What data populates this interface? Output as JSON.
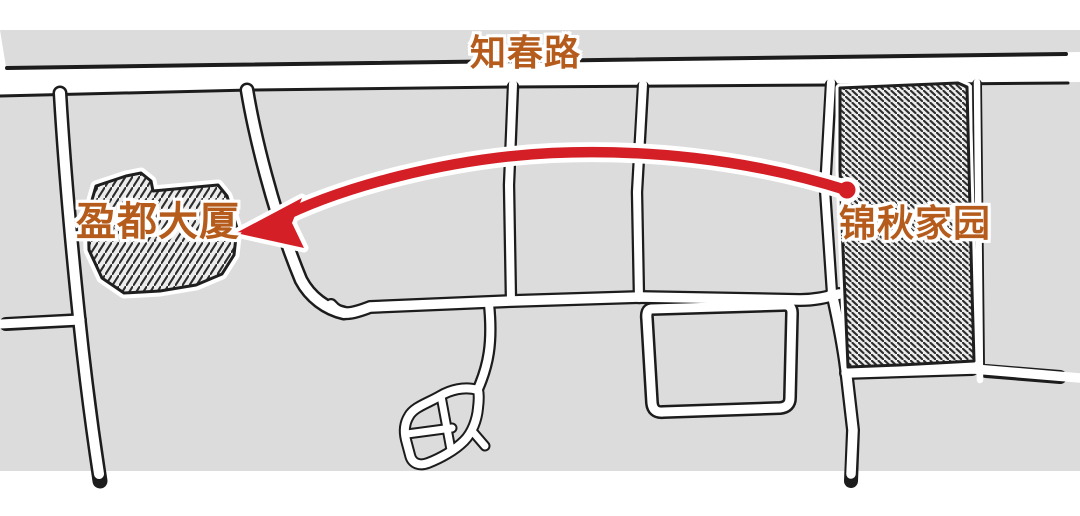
{
  "map": {
    "top_road": {
      "label": "知春路"
    },
    "buildings": [
      {
        "id": "yingdu-building",
        "label": "盈都大厦",
        "style": "hatched"
      },
      {
        "id": "jinqiu-homes",
        "label": "锦秋家园",
        "style": "hatched"
      }
    ],
    "route_arrow": {
      "from_label": "锦秋家园",
      "to_label": "盈都大厦"
    },
    "colors": {
      "label_orange": "#b55c1d",
      "arrow_red": "#d51f26",
      "block_gray": "#dcdcdc",
      "line_ink": "#1c1c1c",
      "page_white": "#ffffff"
    }
  }
}
